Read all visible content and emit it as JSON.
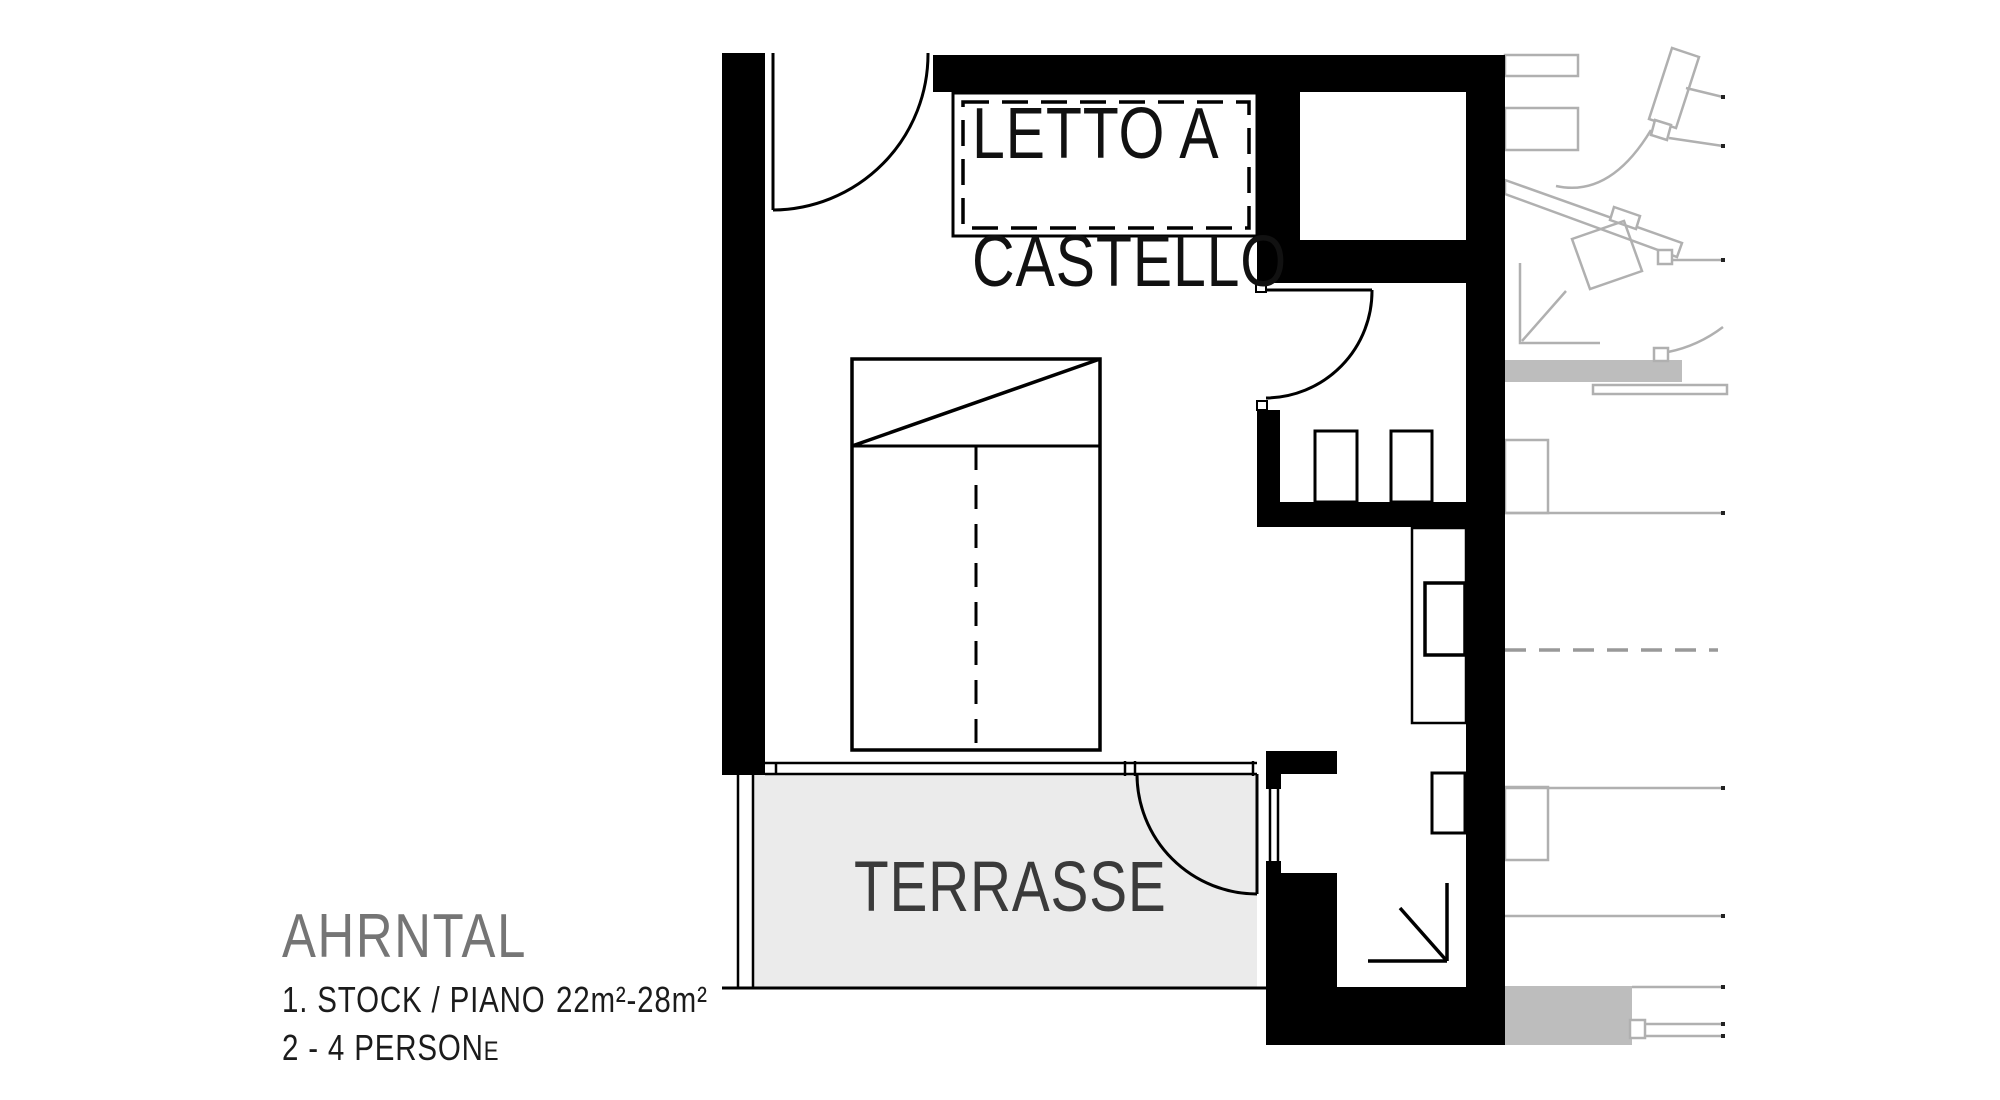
{
  "plan": {
    "title": "AHRNTAL",
    "floor_label": "1. STOCK / PIANO",
    "area_label": "22m²-28m²",
    "occupancy_label_main": "2 - 4 PERSON",
    "occupancy_label_small": "E",
    "rooms": {
      "bunk_bed_line1": "LETTO A",
      "bunk_bed_line2": "CASTELLO",
      "terrace": "TERRASSE"
    },
    "legend_icons": [
      "door-swing-arc",
      "entry-corner-arrow",
      "double-bed-with-center-dashed-line",
      "bunk-bed-dashed-outline"
    ],
    "colors": {
      "wall_black": "#000000",
      "terrace_fill": "#ebebeb",
      "faded_unit_line": "#b0b0b0",
      "slab_fill": "#bdbdbd",
      "dashed_projection_line": "#999999",
      "title_gray": "#757575",
      "text_black": "#1b1b1b",
      "terrace_text": "#3a3a3a"
    }
  }
}
